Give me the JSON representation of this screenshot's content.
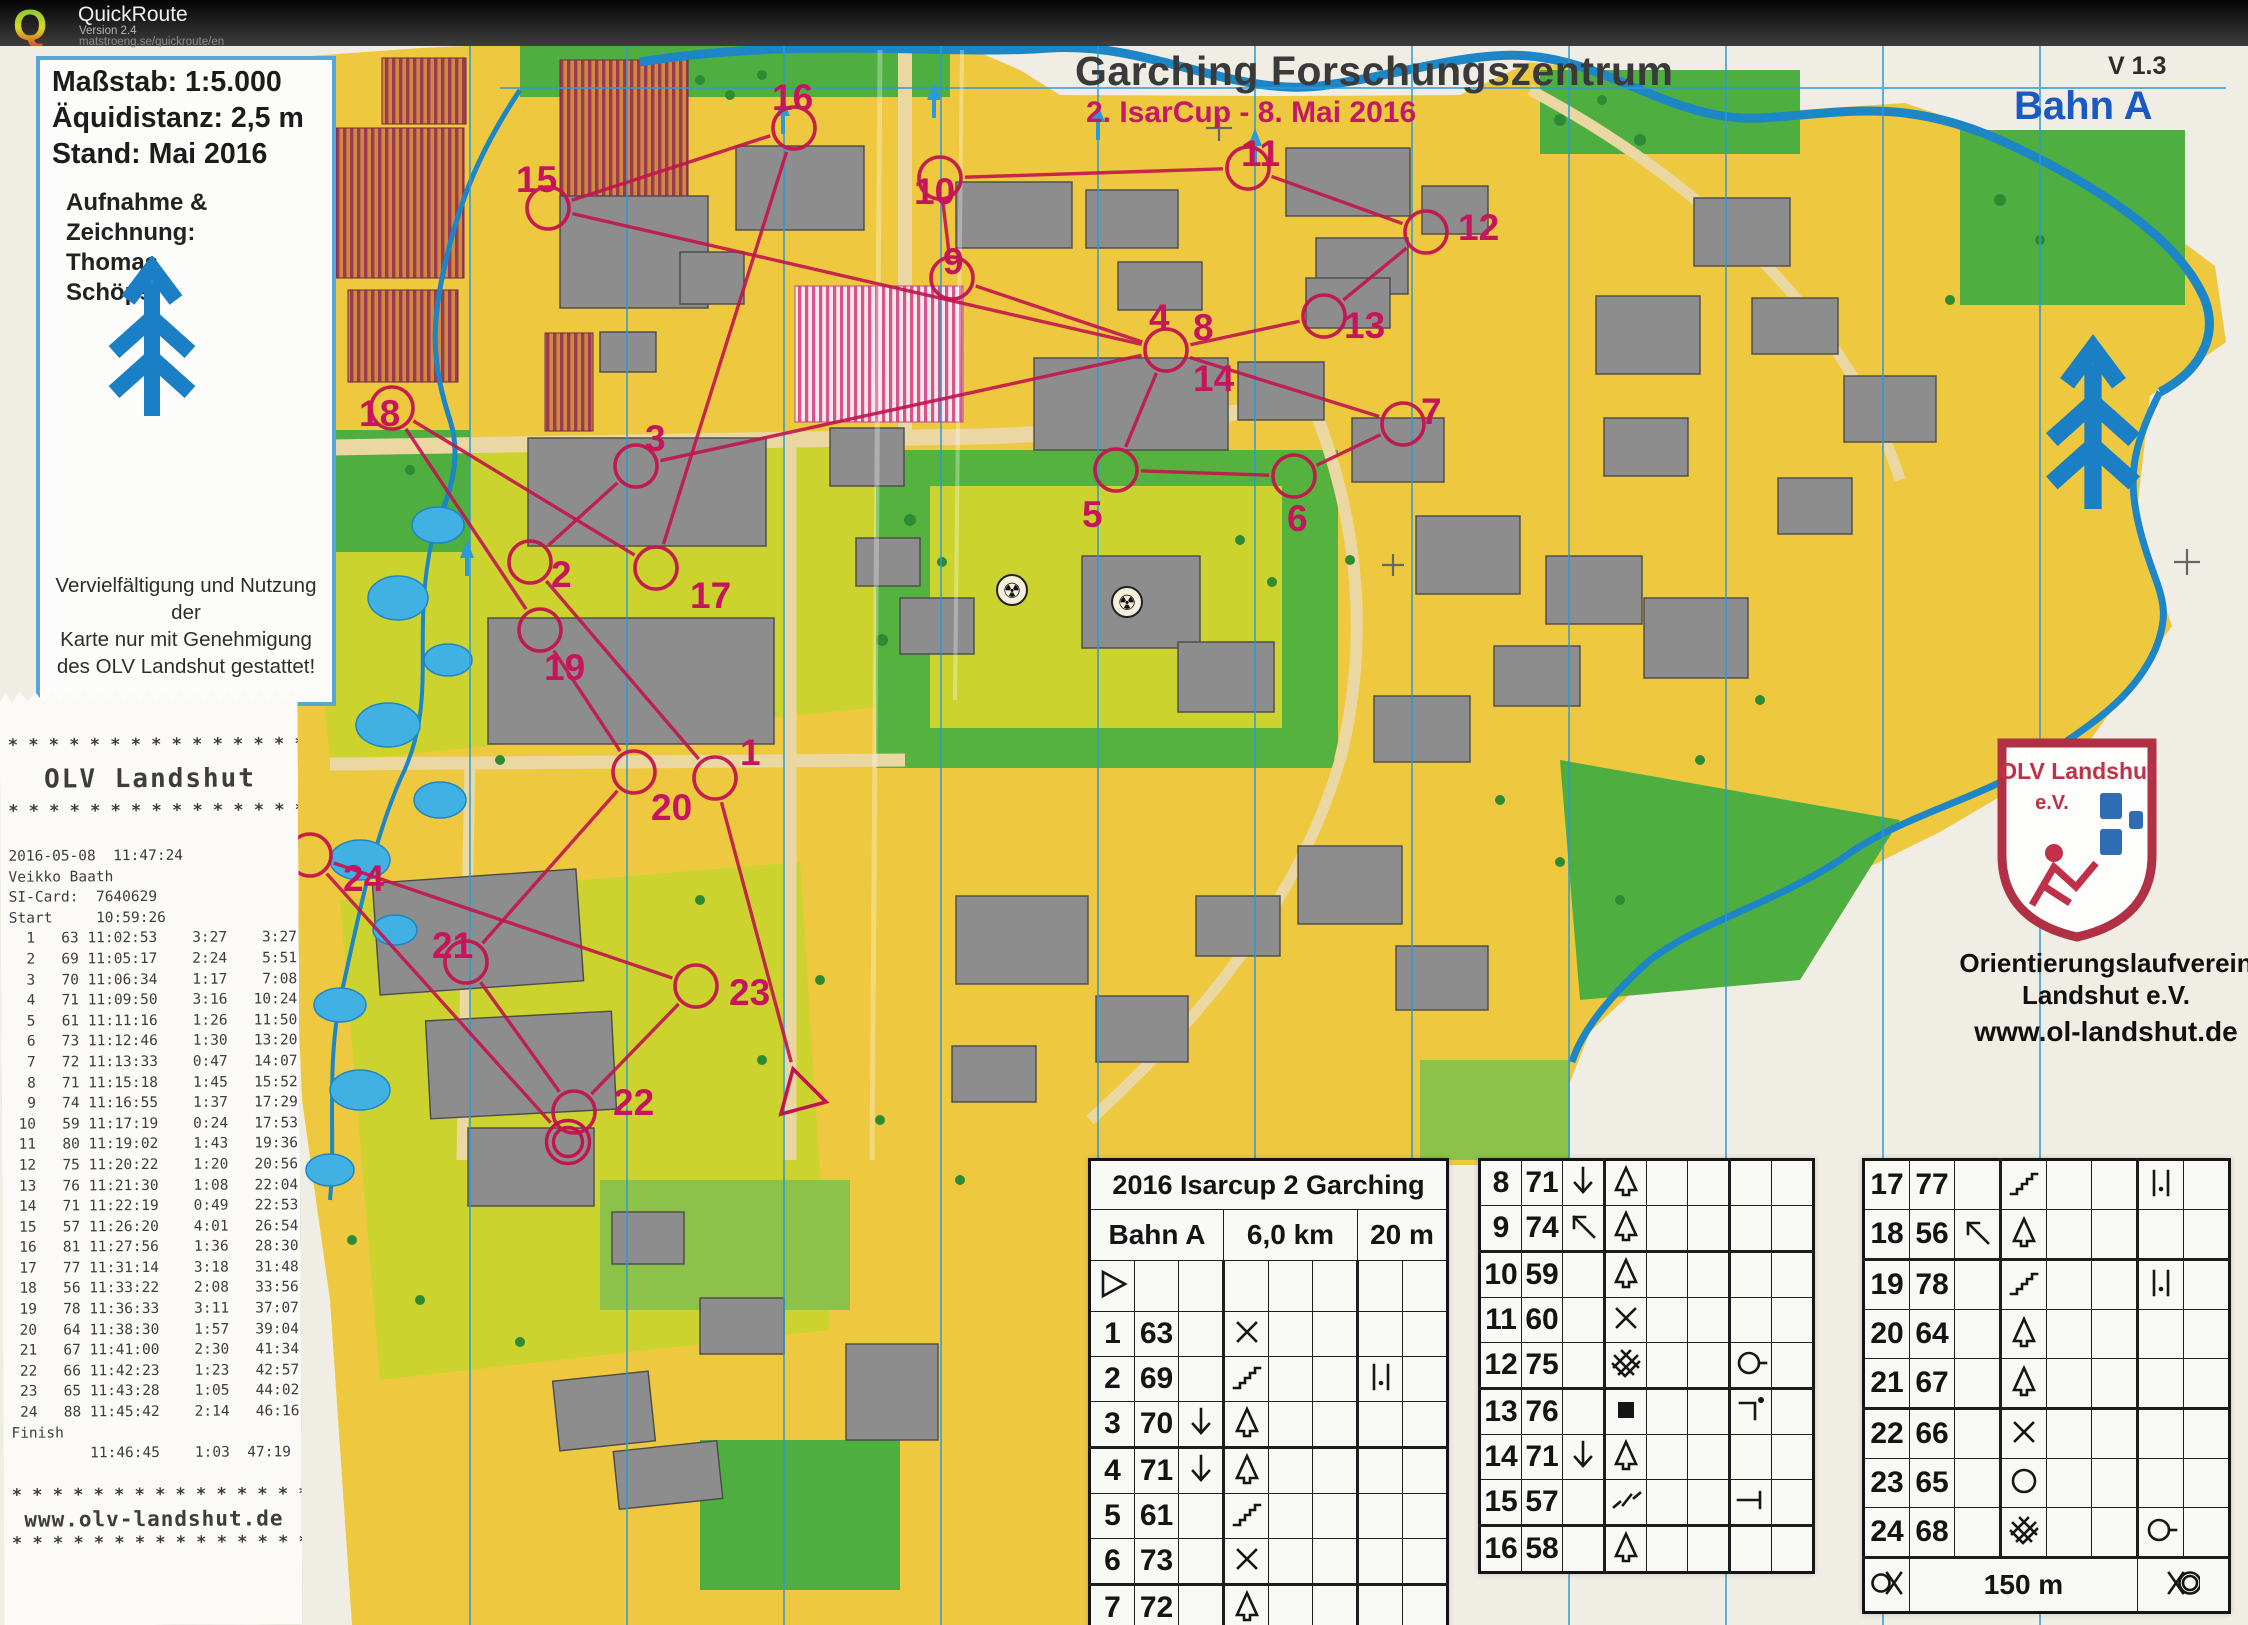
{
  "header": {
    "app_name": "QuickRoute",
    "version": "Version 2.4",
    "url": "matstroeng.se/quickroute/en"
  },
  "map": {
    "title": "Garching Forschungszentrum",
    "subtitle": "2. IsarCup  -  8. Mai 2016",
    "version_label": "V 1.3",
    "course_label": "Bahn A",
    "info_box": {
      "scale": "Maßstab: 1:5.000",
      "equidistance": "Äquidistanz: 2,5 m",
      "state": "Stand: Mai 2016",
      "credit_lines": [
        "Aufnahme &",
        "Zeichnung:",
        "Thomas",
        "Schöps"
      ],
      "copyright_lines": [
        "Vervielfältigung und Nutzung der",
        "Karte nur mit Genehmigung",
        "des OLV Landshut gestattet!"
      ]
    },
    "club": {
      "shield_title": "OLV Landshut",
      "shield_ev": "e.V.",
      "name_line1": "Orientierungslaufverein",
      "name_line2": "Landshut e.V.",
      "website": "www.ol-landshut.de"
    },
    "course": {
      "color": "#c2154e",
      "number_color": "#c6155c",
      "start": {
        "x": 800,
        "y": 1095
      },
      "finish": {
        "x": 568,
        "y": 1142
      },
      "controls": [
        {
          "n": 1,
          "cx": 715,
          "cy": 778,
          "lx": 740,
          "ly": 752
        },
        {
          "n": 2,
          "cx": 530,
          "cy": 562,
          "lx": 551,
          "ly": 574
        },
        {
          "n": 3,
          "cx": 636,
          "cy": 466,
          "lx": 645,
          "ly": 438
        },
        {
          "n": 4,
          "cx": 1166,
          "cy": 350,
          "lx": 1149,
          "ly": 317,
          "shared": false
        },
        {
          "n": 5,
          "cx": 1116,
          "cy": 470,
          "lx": 1082,
          "ly": 514
        },
        {
          "n": 6,
          "cx": 1294,
          "cy": 476,
          "lx": 1287,
          "ly": 518
        },
        {
          "n": 7,
          "cx": 1403,
          "cy": 424,
          "lx": 1421,
          "ly": 411
        },
        {
          "n": 8,
          "cx": 1166,
          "cy": 350,
          "lx": 1193,
          "ly": 327,
          "shared": true
        },
        {
          "n": 9,
          "cx": 952,
          "cy": 278,
          "lx": 943,
          "ly": 261
        },
        {
          "n": 10,
          "cx": 940,
          "cy": 178,
          "lx": 914,
          "ly": 191
        },
        {
          "n": 11,
          "cx": 1248,
          "cy": 168,
          "lx": 1241,
          "ly": 153
        },
        {
          "n": 12,
          "cx": 1426,
          "cy": 232,
          "lx": 1458,
          "ly": 227
        },
        {
          "n": 13,
          "cx": 1324,
          "cy": 316,
          "lx": 1344,
          "ly": 325
        },
        {
          "n": 14,
          "cx": 1166,
          "cy": 350,
          "lx": 1193,
          "ly": 378,
          "shared": true
        },
        {
          "n": 15,
          "cx": 548,
          "cy": 208,
          "lx": 516,
          "ly": 179
        },
        {
          "n": 16,
          "cx": 794,
          "cy": 128,
          "lx": 772,
          "ly": 97
        },
        {
          "n": 17,
          "cx": 656,
          "cy": 568,
          "lx": 690,
          "ly": 595
        },
        {
          "n": 18,
          "cx": 392,
          "cy": 408,
          "lx": 359,
          "ly": 413
        },
        {
          "n": 19,
          "cx": 540,
          "cy": 630,
          "lx": 544,
          "ly": 667
        },
        {
          "n": 20,
          "cx": 634,
          "cy": 772,
          "lx": 651,
          "ly": 807
        },
        {
          "n": 21,
          "cx": 466,
          "cy": 962,
          "lx": 432,
          "ly": 945
        },
        {
          "n": 22,
          "cx": 574,
          "cy": 1112,
          "lx": 613,
          "ly": 1102
        },
        {
          "n": 23,
          "cx": 696,
          "cy": 986,
          "lx": 729,
          "ly": 992
        },
        {
          "n": 24,
          "cx": 310,
          "cy": 855,
          "lx": 343,
          "ly": 878
        }
      ]
    }
  },
  "receipt": {
    "asterisk_line": "* * * * * * * * * * * * * * * * *",
    "club_banner": "OLV Landshut",
    "datetime": "2016-05-08  11:47:24",
    "runner": "Veikko Baath",
    "si_card_label": "SI-Card:",
    "si_card": "7640629",
    "start_label": "Start",
    "start_time": "10:59:26",
    "splits": [
      [
        1,
        "63",
        "11:02:53",
        "3:27",
        "3:27"
      ],
      [
        2,
        "69",
        "11:05:17",
        "2:24",
        "5:51"
      ],
      [
        3,
        "70",
        "11:06:34",
        "1:17",
        "7:08"
      ],
      [
        4,
        "71",
        "11:09:50",
        "3:16",
        "10:24"
      ],
      [
        5,
        "61",
        "11:11:16",
        "1:26",
        "11:50"
      ],
      [
        6,
        "73",
        "11:12:46",
        "1:30",
        "13:20"
      ],
      [
        7,
        "72",
        "11:13:33",
        "0:47",
        "14:07"
      ],
      [
        8,
        "71",
        "11:15:18",
        "1:45",
        "15:52"
      ],
      [
        9,
        "74",
        "11:16:55",
        "1:37",
        "17:29"
      ],
      [
        10,
        "59",
        "11:17:19",
        "0:24",
        "17:53"
      ],
      [
        11,
        "80",
        "11:19:02",
        "1:43",
        "19:36"
      ],
      [
        12,
        "75",
        "11:20:22",
        "1:20",
        "20:56"
      ],
      [
        13,
        "76",
        "11:21:30",
        "1:08",
        "22:04"
      ],
      [
        14,
        "71",
        "11:22:19",
        "0:49",
        "22:53"
      ],
      [
        15,
        "57",
        "11:26:20",
        "4:01",
        "26:54"
      ],
      [
        16,
        "81",
        "11:27:56",
        "1:36",
        "28:30"
      ],
      [
        17,
        "77",
        "11:31:14",
        "3:18",
        "31:48"
      ],
      [
        18,
        "56",
        "11:33:22",
        "2:08",
        "33:56"
      ],
      [
        19,
        "78",
        "11:36:33",
        "3:11",
        "37:07"
      ],
      [
        20,
        "64",
        "11:38:30",
        "1:57",
        "39:04"
      ],
      [
        21,
        "67",
        "11:41:00",
        "2:30",
        "41:34"
      ],
      [
        22,
        "66",
        "11:42:23",
        "1:23",
        "42:57"
      ],
      [
        23,
        "65",
        "11:43:28",
        "1:05",
        "44:02"
      ],
      [
        24,
        "88",
        "11:45:42",
        "2:14",
        "46:16"
      ]
    ],
    "finish_label": "Finish",
    "finish_time": "11:46:45",
    "finish_split": "1:03",
    "total_time": "47:19",
    "website": "www.olv-landshut.de"
  },
  "control_sheet": {
    "title": "2016 Isarcup 2 Garching",
    "course": "Bahn A",
    "length": "6,0 km",
    "climb": "20 m",
    "distance_note": "150 m",
    "tables": [
      {
        "header": true,
        "start_row": true,
        "footer": false,
        "rows": [
          {
            "n": "1",
            "code": "63",
            "c": "",
            "d": "cross",
            "g": ""
          },
          {
            "n": "2",
            "code": "69",
            "c": "",
            "d": "stairs",
            "g": "between"
          },
          {
            "n": "3",
            "code": "70",
            "c": "arrow-down",
            "d": "tree",
            "g": ""
          },
          {
            "n": "4",
            "code": "71",
            "c": "arrow-down",
            "d": "tree",
            "g": ""
          },
          {
            "n": "5",
            "code": "61",
            "c": "",
            "d": "stairs",
            "g": ""
          },
          {
            "n": "6",
            "code": "73",
            "c": "",
            "d": "cross",
            "g": ""
          },
          {
            "n": "7",
            "code": "72",
            "c": "",
            "d": "tree",
            "g": ""
          }
        ]
      },
      {
        "header": false,
        "start_row": false,
        "footer": false,
        "rows": [
          {
            "n": "8",
            "code": "71",
            "c": "arrow-down",
            "d": "tree",
            "g": ""
          },
          {
            "n": "9",
            "code": "74",
            "c": "arrow-upleft",
            "d": "tree",
            "g": ""
          },
          {
            "n": "10",
            "code": "59",
            "c": "",
            "d": "tree",
            "g": ""
          },
          {
            "n": "11",
            "code": "60",
            "c": "",
            "d": "cross",
            "g": ""
          },
          {
            "n": "12",
            "code": "75",
            "c": "",
            "d": "thicket",
            "g": "circle-tail"
          },
          {
            "n": "13",
            "code": "76",
            "c": "",
            "d": "square",
            "g": "corner-dot"
          },
          {
            "n": "14",
            "code": "71",
            "c": "arrow-down",
            "d": "tree",
            "g": ""
          },
          {
            "n": "15",
            "code": "57",
            "c": "",
            "d": "junction",
            "g": "tape-end"
          },
          {
            "n": "16",
            "code": "58",
            "c": "",
            "d": "tree",
            "g": ""
          }
        ]
      },
      {
        "header": false,
        "start_row": false,
        "footer": true,
        "rows": [
          {
            "n": "17",
            "code": "77",
            "c": "",
            "d": "stairs",
            "g": "between"
          },
          {
            "n": "18",
            "code": "56",
            "c": "arrow-upleft",
            "d": "tree",
            "g": ""
          },
          {
            "n": "19",
            "code": "78",
            "c": "",
            "d": "stairs",
            "g": "between"
          },
          {
            "n": "20",
            "code": "64",
            "c": "",
            "d": "tree",
            "g": ""
          },
          {
            "n": "21",
            "code": "67",
            "c": "",
            "d": "tree",
            "g": ""
          },
          {
            "n": "22",
            "code": "66",
            "c": "",
            "d": "cross",
            "g": ""
          },
          {
            "n": "23",
            "code": "65",
            "c": "",
            "d": "circle",
            "g": ""
          },
          {
            "n": "24",
            "code": "68",
            "c": "",
            "d": "thicket",
            "g": "circle-tail"
          }
        ]
      }
    ]
  }
}
